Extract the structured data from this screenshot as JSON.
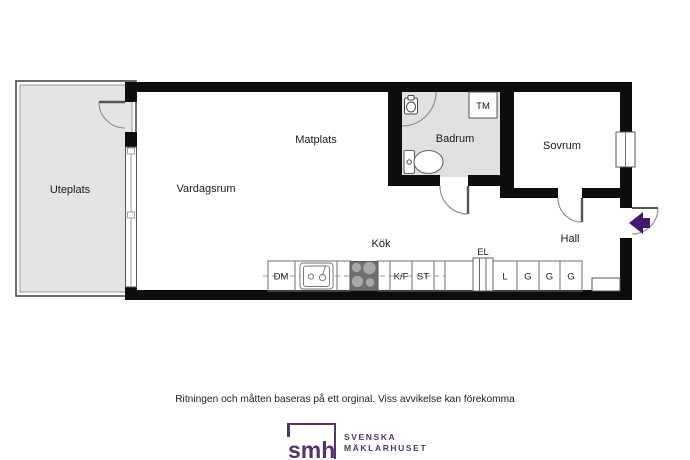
{
  "plan": {
    "rooms": {
      "uteplats": "Uteplats",
      "vardagsrum": "Vardagsrum",
      "matplats": "Matplats",
      "badrum": "Badrum",
      "sovrum": "Sovrum",
      "hall": "Hall",
      "kok": "Kök"
    },
    "fixtures": {
      "tm": "TM",
      "el": "EL",
      "dm": "DM",
      "kf": "K/F",
      "st": "ST",
      "l": "L",
      "g1": "G",
      "g2": "G",
      "g3": "G"
    }
  },
  "footer": {
    "disclaimer": "Ritningen och måtten baseras på ett orginal. Viss avvikelse kan förekomma"
  },
  "logo": {
    "mark": "smh",
    "name_line1": "SVENSKA",
    "name_line2": "MÄKLARHUSET"
  },
  "colors": {
    "wall": "#0d0d0d",
    "patio_fill": "#e4e4e4",
    "bathroom_fill": "#e1e1e1",
    "stove_fill": "#6f6f6f",
    "burner_fill": "#a8a8a8",
    "entry_arrow": "#44186f",
    "logo_purple": "#55336e"
  }
}
